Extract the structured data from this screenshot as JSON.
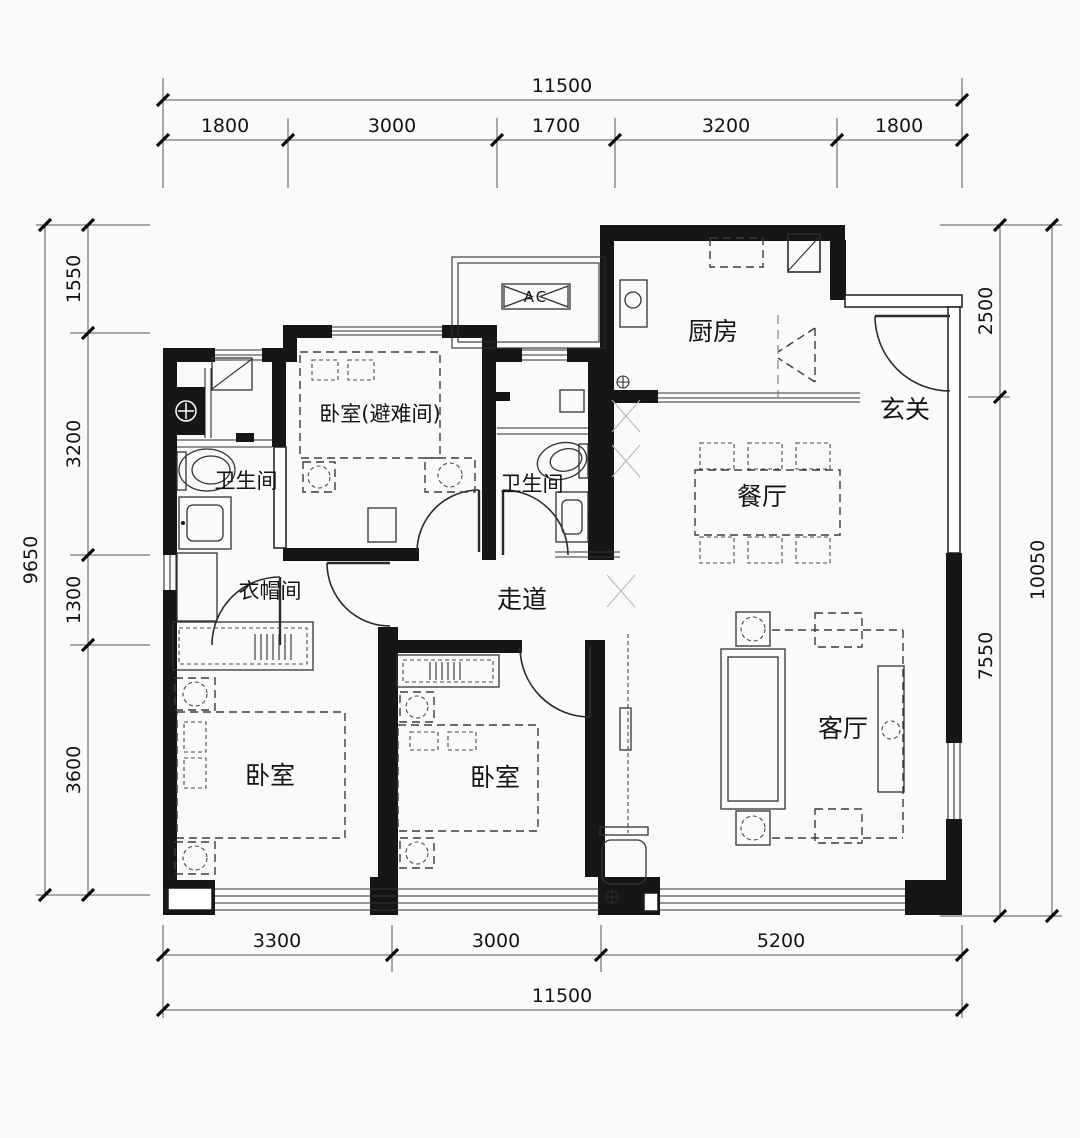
{
  "drawing": {
    "type": "apartment-floor-plan",
    "background": "#fafaf8",
    "wall_color": "#161616",
    "line_color": "#2b2b2b"
  },
  "dimensions": {
    "top": {
      "total": "11500",
      "segments": [
        "1800",
        "3000",
        "1700",
        "3200",
        "1800"
      ]
    },
    "bottom": {
      "total": "11500",
      "segments": [
        "3300",
        "3000",
        "5200"
      ]
    },
    "left": {
      "total": "9650",
      "segments": [
        "1550",
        "3200",
        "1300",
        "3600"
      ]
    },
    "right": {
      "overall": "10050",
      "segments": [
        "2500",
        "7550"
      ]
    }
  },
  "rooms": {
    "kitchen": "厨房",
    "entry": "玄关",
    "dining": "餐厅",
    "living": "客厅",
    "refuge_bedroom": "卧室(避难间)",
    "bathroom1": "卫生间",
    "bathroom2": "卫生间",
    "cloakroom": "衣帽间",
    "corridor": "走道",
    "bedroom_sw": "卧室",
    "bedroom_s": "卧室",
    "ac_platform": "AC"
  }
}
